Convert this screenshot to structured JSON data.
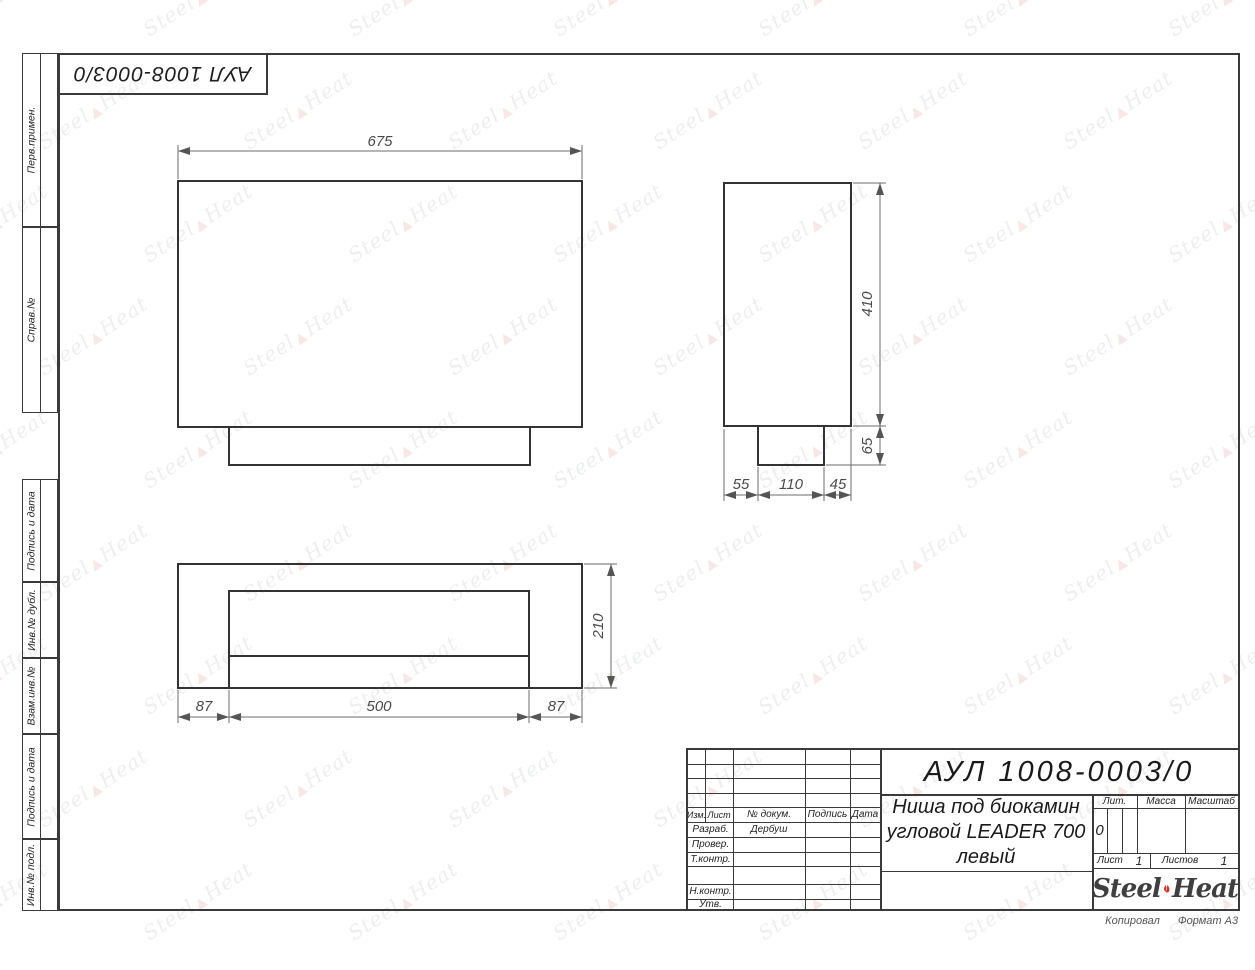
{
  "colors": {
    "flame_red": "#e02b20",
    "line_dark": "#3a3a3a"
  },
  "corner_stamp": {
    "doc_number": "АУЛ 1008-0003/0"
  },
  "side_columns": {
    "top": [
      {
        "label": "Перв.примен."
      },
      {
        "label": "Справ.№"
      }
    ],
    "bottom": [
      {
        "label": "Подпись и дата"
      },
      {
        "label": "Инв.№ дубл."
      },
      {
        "label": "Взам.инв.№"
      },
      {
        "label": "Подпись и дата"
      },
      {
        "label": "Инв.№ подл."
      }
    ]
  },
  "views": {
    "front": {
      "dim_width": "675"
    },
    "side": {
      "dim_height": "410",
      "dim_base_height": "65",
      "dim_bottom": [
        "55",
        "110",
        "45"
      ]
    },
    "bottom": {
      "dim_depth": "210",
      "dim_bottom": [
        "87",
        "500",
        "87"
      ]
    }
  },
  "title_block": {
    "doc_number": "АУЛ 1008-0003/0",
    "title_line1": "Ниша под биокамин",
    "title_line2": "угловой LEADER 700",
    "title_line3": "левый",
    "header": {
      "izm": "Изм.",
      "list": "Лист",
      "doc": "№ докум.",
      "sign": "Подпись",
      "date": "Дата"
    },
    "roles": {
      "razrab": "Разраб.",
      "razrab_name": "Дербуш",
      "prover": "Провер.",
      "tkontr": "Т.контр.",
      "nkontr": "Н.контр.",
      "utv": "Утв."
    },
    "lit": {
      "label": "Лит.",
      "value": "0"
    },
    "massa_label": "Масса",
    "masshtab_label": "Масштаб",
    "sheets": {
      "list_label": "Лист",
      "list_value": "1",
      "listov_label": "Листов",
      "listov_value": "1"
    }
  },
  "logo": {
    "steel": "Steel",
    "heat": "Heat"
  },
  "footer": {
    "kopiroval": "Копировал",
    "format": "Формат А3"
  },
  "watermark": {
    "steel": "Steel",
    "heat": "Heat"
  }
}
